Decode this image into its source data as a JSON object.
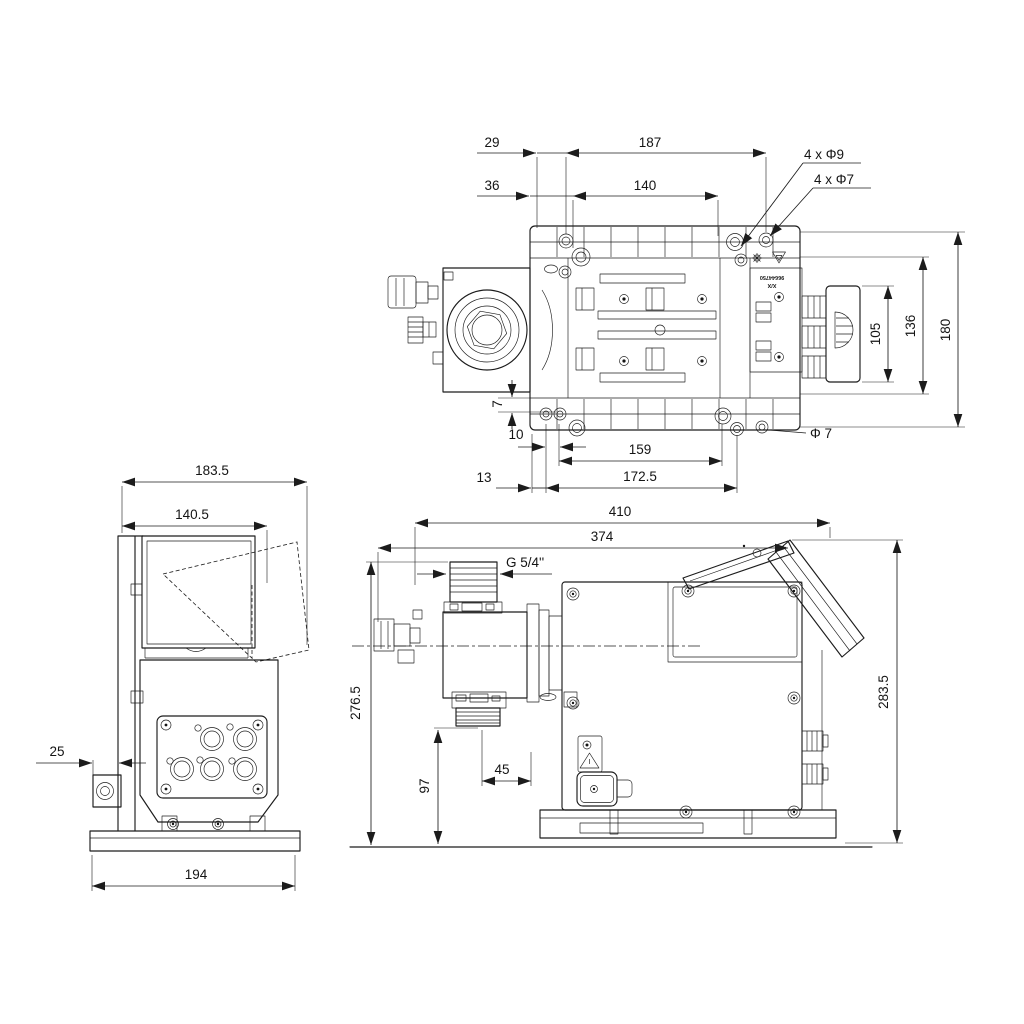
{
  "colors": {
    "background": "#ffffff",
    "line": "#1c1c1c"
  },
  "views": {
    "top": {
      "dims": {
        "d29": "29",
        "d187": "187",
        "d36": "36",
        "d140": "140",
        "holes_9": "4 x Φ9",
        "holes_7": "4 x Φ7",
        "d105": "105",
        "d136": "136",
        "d180": "180",
        "d7": "7",
        "d10": "10",
        "d159": "159",
        "phi7": "Φ 7",
        "d13": "13",
        "d172_5": "172.5"
      },
      "marking": {
        "line1": "X/X",
        "line2": "96644750"
      },
      "icons": {
        "gear": "gear-mark",
        "triangle": "recycling-triangle-mark"
      }
    },
    "side": {
      "dims": {
        "d183_5": "183.5",
        "d140_5": "140.5",
        "d25": "25",
        "d194": "194"
      }
    },
    "front": {
      "dims": {
        "d410": "410",
        "d374": "374",
        "thread": "G 5/4''",
        "d276_5": "276.5",
        "d283_5": "283.5",
        "d97": "97",
        "d45": "45"
      }
    }
  }
}
